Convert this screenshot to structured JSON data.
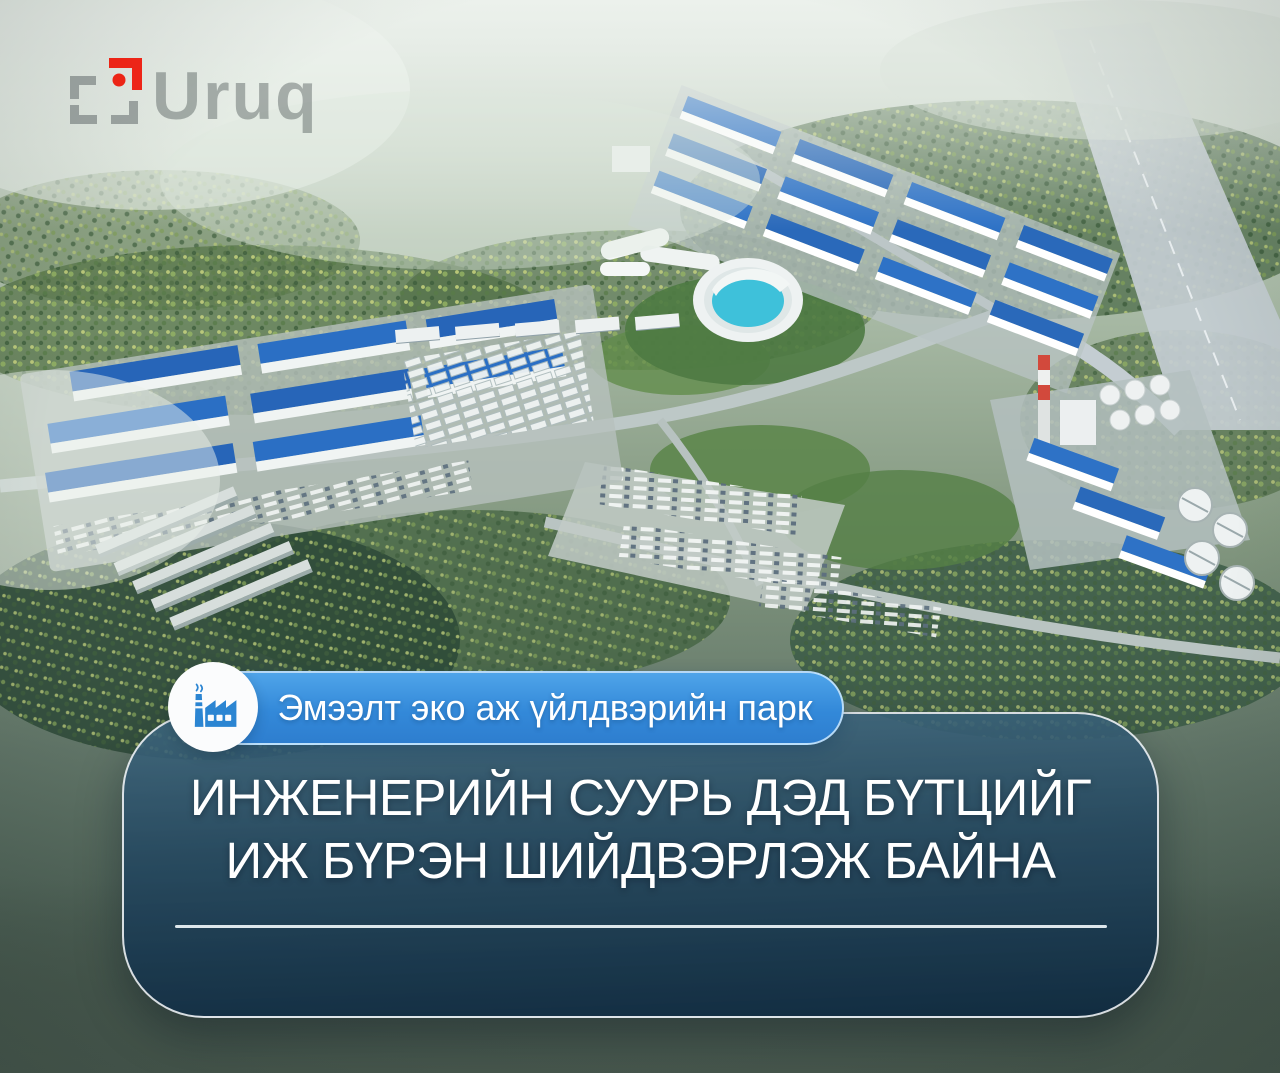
{
  "brand": {
    "wordmark": "Uruq",
    "accent_red": "#ee1506",
    "mark_gray": "#5d6466"
  },
  "badge": {
    "label": "Эмээлт эко аж үйлдвэрийн парк",
    "icon": "factory-icon",
    "blue": "#3b92dd"
  },
  "headline": {
    "line1": "ИНЖЕНЕРИЙН СУУРЬ ДЭД БҮТЦИЙГ",
    "line2": "ИЖ БҮРЭН ШИЙДВЭРЛЭЖ БАЙНА",
    "card_top_color": "#3e6780",
    "card_bottom_color": "#112c41",
    "divider_color": "#eef5f9"
  }
}
